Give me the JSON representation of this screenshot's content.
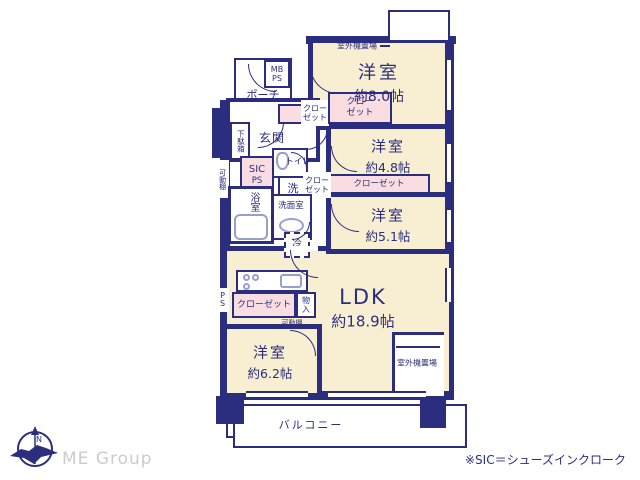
{
  "colors": {
    "wall": "#2b2e7e",
    "room_floor": "#f8efd3",
    "closet_pink": "#fadde0",
    "fixture_blue": "#97a0cc",
    "logo_gray": "#cccccc",
    "background": "#ffffff"
  },
  "rooms": {
    "west8": {
      "label": "洋室",
      "size": "約8.0帖"
    },
    "west48": {
      "label": "洋室",
      "size": "約4.8帖"
    },
    "west51": {
      "label": "洋室",
      "size": "約5.1帖"
    },
    "west62": {
      "label": "洋室",
      "size": "約6.2帖"
    },
    "ldk": {
      "label": "LDK",
      "size": "約18.9帖"
    }
  },
  "labels": {
    "balcony": "バルコニー",
    "porch": "ポーチ",
    "entrance": "玄関",
    "mb": "MB",
    "ps": "PS",
    "outdoor_unit": "室外機置場",
    "closet": "クローゼット",
    "shoe_cabinet": "下駄箱",
    "sic": "SIC",
    "sic_ps": "PS",
    "movable_shelf": "可動棚",
    "toilet": "トイレ",
    "laundry": "洗",
    "washroom": "洗面室",
    "bathroom": "浴室",
    "fridge": "冷",
    "storage": "物入",
    "pipe_space": "PS"
  },
  "footer": {
    "logo": "ME Group",
    "note": "※SIC＝シューズインクローク",
    "compass": "N"
  }
}
